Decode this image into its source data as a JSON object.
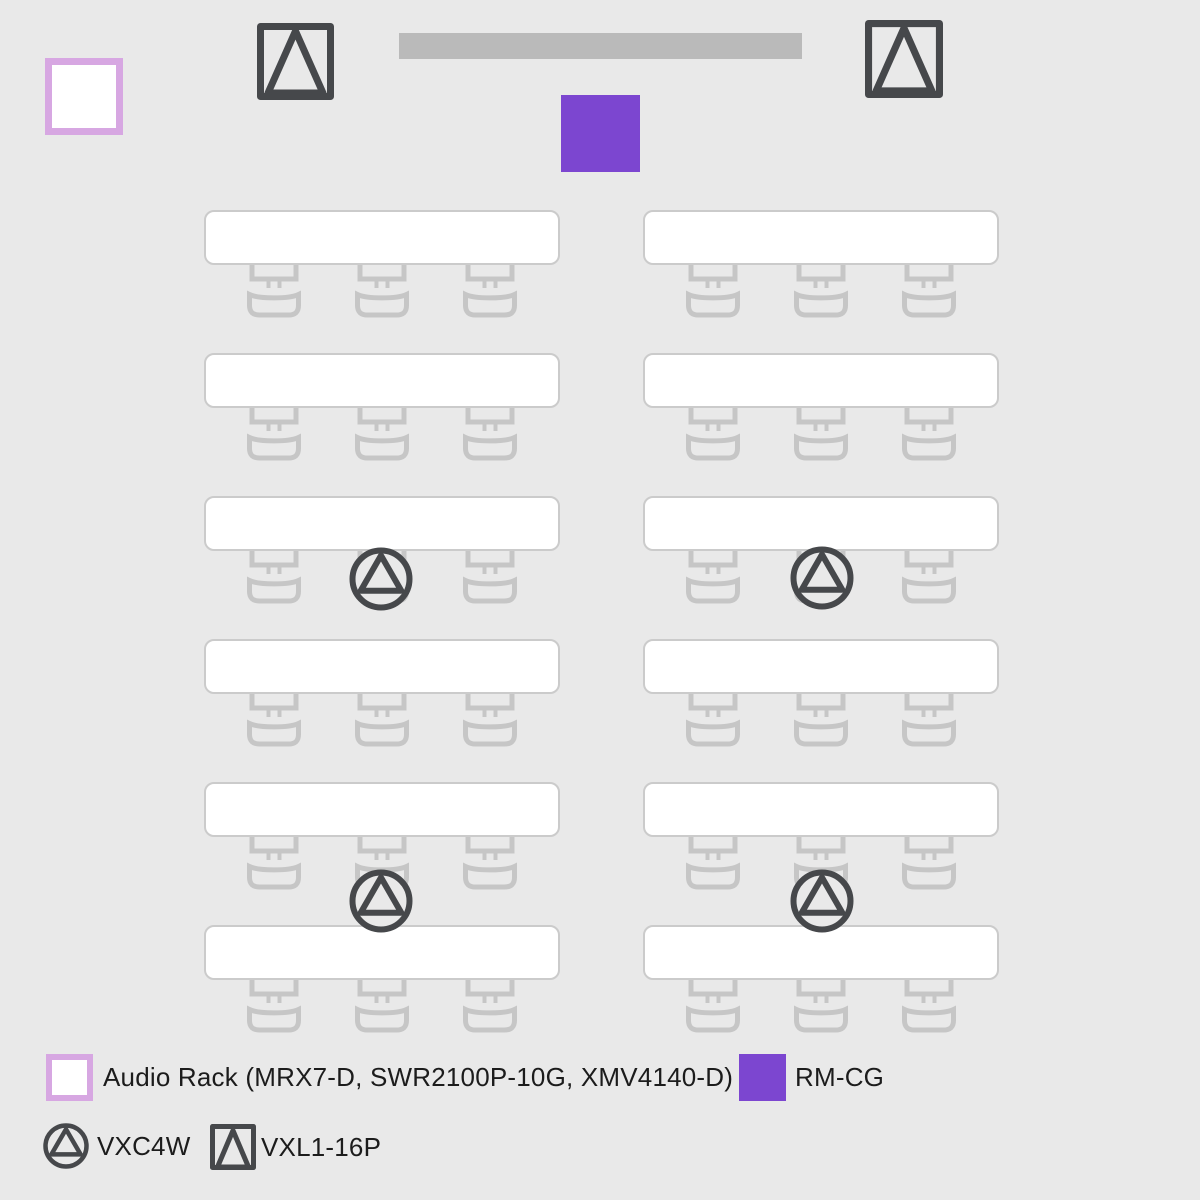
{
  "colors": {
    "background": "#E9E9E9",
    "table_fill": "#FFFFFF",
    "table_border": "#CBCBCB",
    "chair_stroke": "#C6C6C6",
    "dark_icon": "#46484B",
    "rm_cg_purple": "#7C46D0",
    "audio_rack_border": "#D7A7E2",
    "screen_bar_gray": "#BABABA",
    "text": "#1C1C1C"
  },
  "room": {
    "audio_rack": {
      "x": 45,
      "y": 58,
      "w": 78,
      "h": 77
    },
    "screen_bar": {
      "x": 399,
      "y": 33,
      "w": 403,
      "h": 26
    },
    "rm_cg": {
      "x": 561,
      "y": 95,
      "w": 79,
      "h": 77
    },
    "wall_speakers": [
      {
        "x": 257,
        "y": 23,
        "size": 77
      },
      {
        "x": 865,
        "y": 20,
        "size": 78
      }
    ],
    "table_size": {
      "w": 356,
      "h": 55
    },
    "tables": [
      {
        "x": 204,
        "y": 210
      },
      {
        "x": 643,
        "y": 210
      },
      {
        "x": 204,
        "y": 353
      },
      {
        "x": 643,
        "y": 353
      },
      {
        "x": 204,
        "y": 496
      },
      {
        "x": 643,
        "y": 496
      },
      {
        "x": 204,
        "y": 639
      },
      {
        "x": 643,
        "y": 639
      },
      {
        "x": 204,
        "y": 782
      },
      {
        "x": 643,
        "y": 782
      },
      {
        "x": 204,
        "y": 925
      },
      {
        "x": 643,
        "y": 925
      }
    ],
    "chair_center_offsets": [
      70,
      178,
      286
    ],
    "ceiling_speakers": [
      {
        "cx": 381,
        "cy": 579
      },
      {
        "cx": 822,
        "cy": 578
      },
      {
        "cx": 381,
        "cy": 901
      },
      {
        "cx": 822,
        "cy": 901
      }
    ]
  },
  "legend": {
    "audio_rack_label": "Audio Rack (MRX7-D, SWR2100P-10G, XMV4140-D)",
    "rm_cg_label": "RM-CG",
    "vxc_label": "VXC4W",
    "vxl_label": "VXL1-16P"
  }
}
